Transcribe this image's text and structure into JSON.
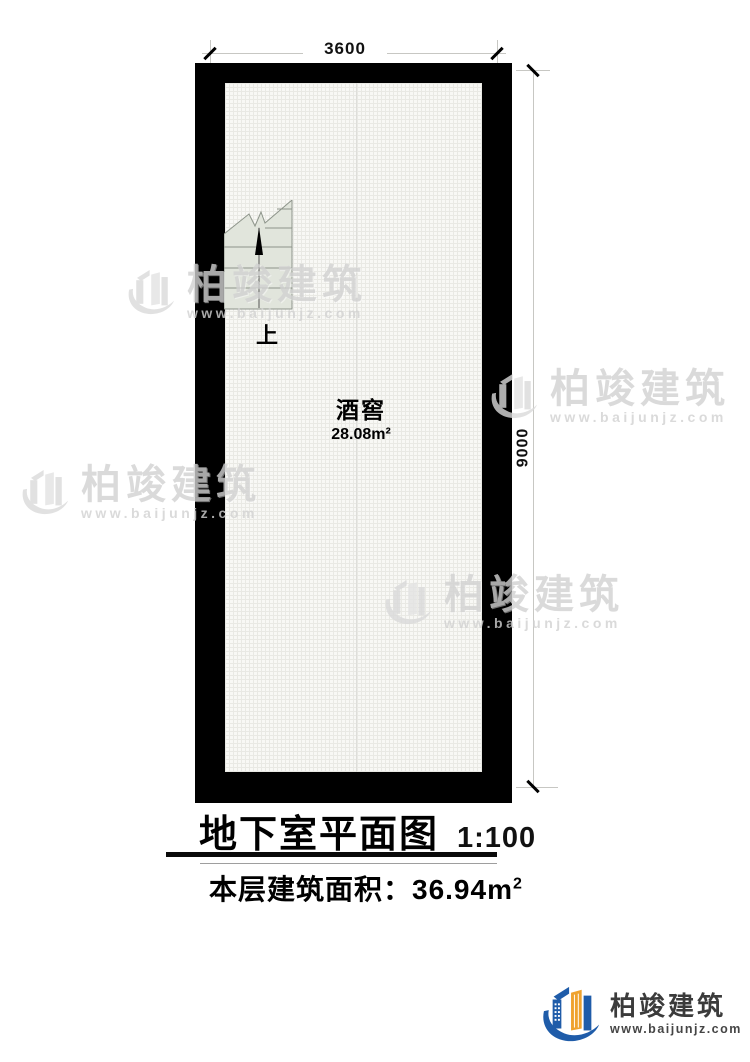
{
  "plan": {
    "title": "地下室平面图",
    "scale": "1:100",
    "area_caption": "本层建筑面积：36.94m",
    "area_caption_sup": "2",
    "room_name": "酒窖",
    "room_area": "28.08m²",
    "stairs_label": "上",
    "dim_width": "3600",
    "dim_height": "9000"
  },
  "watermark": {
    "brand": "柏竣建筑",
    "url": "www.baijunjz.com"
  },
  "logo": {
    "brand": "柏竣建筑",
    "url": "www.baijunjz.com"
  },
  "colors": {
    "wall": "#000000",
    "floor": "#f8f8f5",
    "stairs_fill": "#e1e5dc",
    "dimension_line": "#c7c7c3",
    "logo_blue": "#1f5ca9",
    "logo_orange": "#efa22d",
    "watermark_gray": "#d2d2d2"
  }
}
